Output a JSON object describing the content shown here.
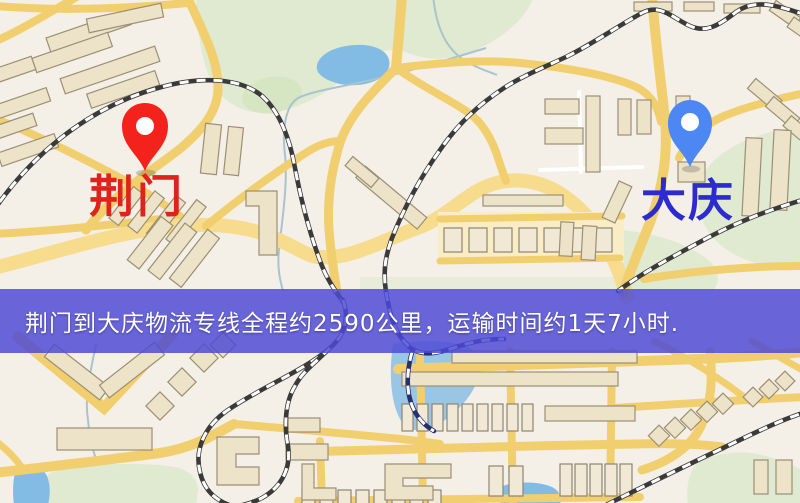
{
  "map": {
    "origin": {
      "name": "荆门"
    },
    "destination": {
      "name": "大庆"
    },
    "banner": {
      "text": "荆门到大庆物流专线全程约2590公里，运输时间约1天7小时."
    },
    "colors": {
      "origin_marker": "#f3231b",
      "origin_label": "#e0221a",
      "destination_marker": "#4c87f3",
      "destination_label": "#2b2bd0",
      "banner_background": "#4d4ad5",
      "banner_text": "#ffffff",
      "road": "#f2cf6e",
      "park": "#dfead0",
      "water": "#82bce4",
      "building": "#ece3c9",
      "railway": "#3a3a3a",
      "background": "#f4efe7"
    }
  }
}
